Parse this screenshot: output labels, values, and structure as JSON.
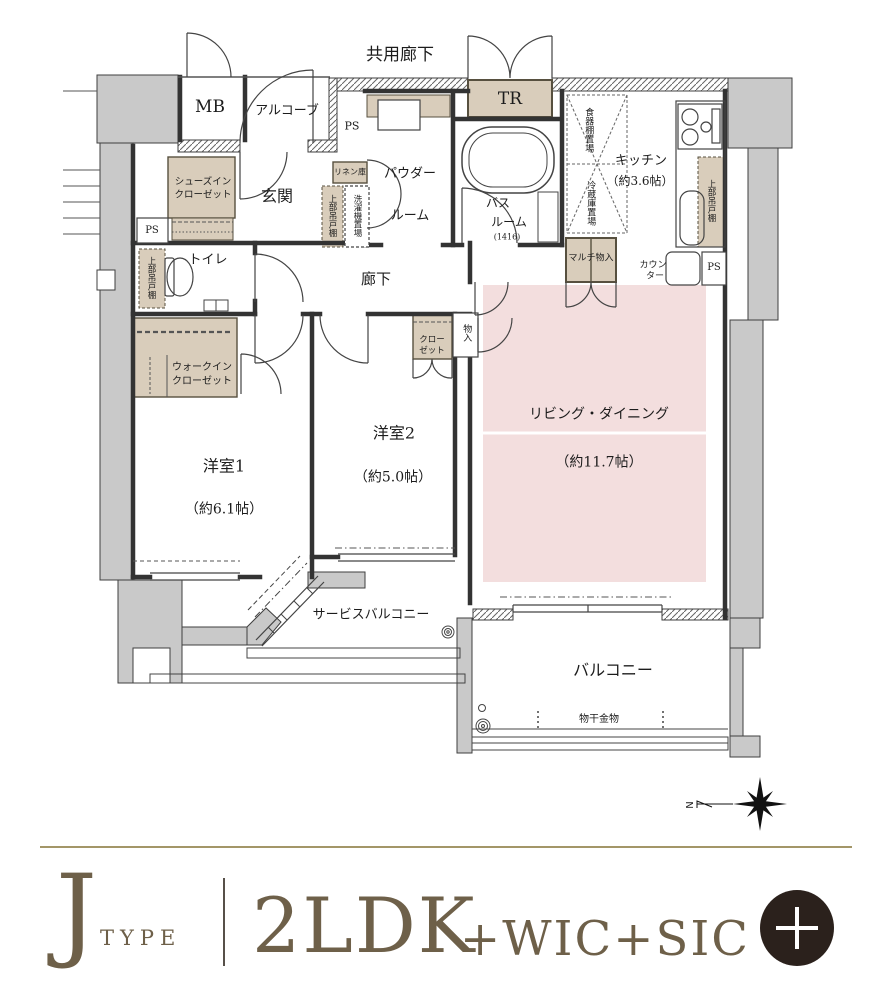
{
  "plan": {
    "labels": {
      "common_corridor": "共用廊下",
      "mb": "MB",
      "alcove": "アルコーブ",
      "tr": "TR",
      "ps": "PS",
      "genkan": "玄関",
      "shoes_line1": "シューズイン",
      "shoes_line2": "クローゼット",
      "linen": "リネン庫",
      "upper_cabinet": "上部吊戸棚",
      "washer": "洗濯機置場",
      "powder_line1": "パウダー",
      "powder_line2": "ルーム",
      "bath_line1": "バス",
      "bath_line2": "ルーム",
      "bath_size": "(1416)",
      "toilet": "トイレ",
      "hallway": "廊下",
      "wic_line1": "ウォークイン",
      "wic_line2": "クローゼット",
      "kitchen": "キッチン",
      "kitchen_size": "（約3.6帖）",
      "dish_shelf": "食器棚置場",
      "fridge": "冷蔵庫置場",
      "counter_line1": "カウン",
      "counter_line2": "ター",
      "multi_storage": "マルチ物入",
      "closet_line1": "クロー",
      "closet_line2": "ゼット",
      "storage": "物入",
      "room1": "洋室1",
      "room1_size": "（約6.1帖）",
      "room2": "洋室2",
      "room2_size": "（約5.0帖）",
      "living_dining": "リビング・ダイニング",
      "living_dining_size": "（約11.7帖）",
      "service_balcony": "サービスバルコニー",
      "balcony": "バルコニー",
      "laundry_hardware": "物干金物",
      "north": "N"
    }
  },
  "footer": {
    "type_letter": "J",
    "type_word": "TYPE",
    "layout": "2LDK",
    "layout_suffix": "+WIC+SIC"
  },
  "colors": {
    "accent_brown": "#6e6049",
    "badge_dark": "#2b211c",
    "floor_pink": "#f3dede",
    "storage_beige": "#d9cdbb",
    "concrete_gray": "#c9c9c9",
    "rule_tan": "#a39668"
  }
}
